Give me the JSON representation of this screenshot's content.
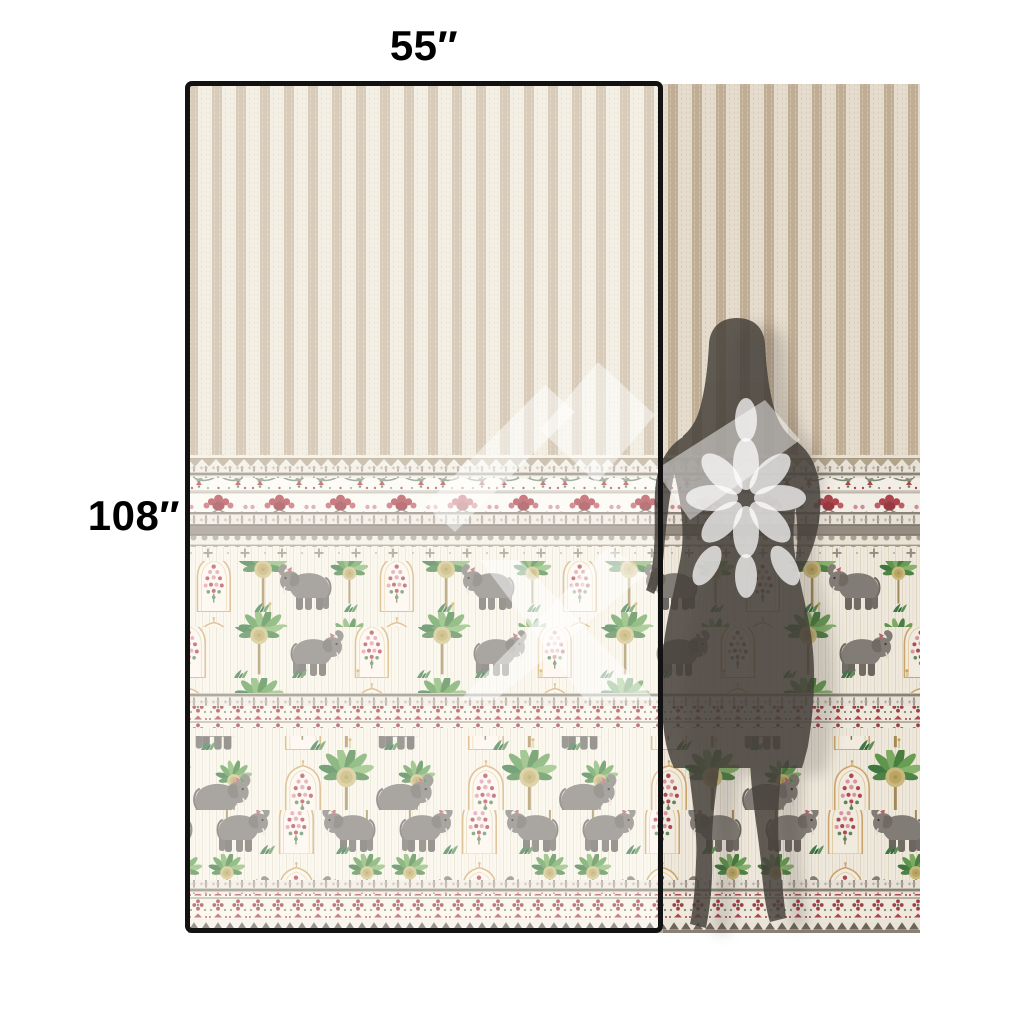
{
  "page": {
    "background": "#ffffff"
  },
  "measurements": {
    "width_label": "55″",
    "height_label": "108″"
  },
  "panel": {
    "frame_color": "#121212",
    "stripe_tan": "#c8b59c",
    "stripe_cream": "#efe8d9",
    "floral_red": "#b2454e",
    "leaf_green": "#4e8748",
    "elephant_gray": "#84807a",
    "band_taupe": "#9a9187",
    "silhouette_gray": "#45403a"
  },
  "figures": {
    "silhouette_icon": "woman-silhouette",
    "watermark_icon": "flower-logo-watermark",
    "motifs": [
      "elephant",
      "palm-tree",
      "mughal-arch",
      "floral-tower",
      "carnation-border"
    ]
  }
}
